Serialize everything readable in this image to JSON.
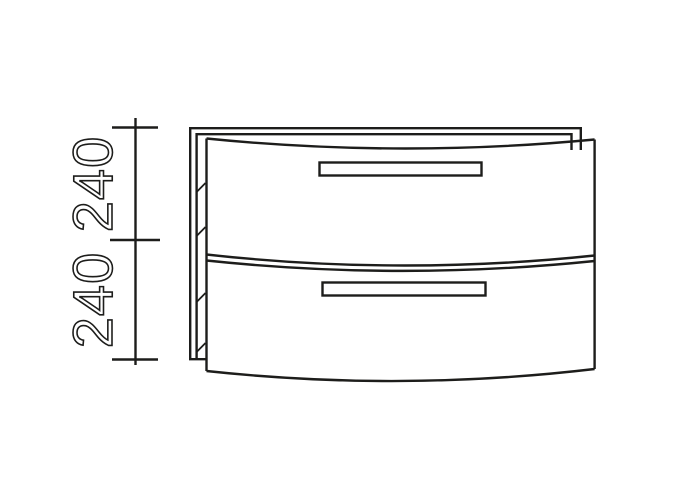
{
  "drawing": {
    "type": "furniture technical line drawing, front elevation",
    "subject": "two-drawer base cabinet with bowed drawer fronts and bar handles",
    "background_color": "#ffffff",
    "line_color": "#1d1d1b",
    "drawer_count": 2,
    "dimension": {
      "upper_label": "240",
      "lower_label": "240",
      "orientation": "vertical, rotated 90deg, read bottom-to-top"
    }
  }
}
